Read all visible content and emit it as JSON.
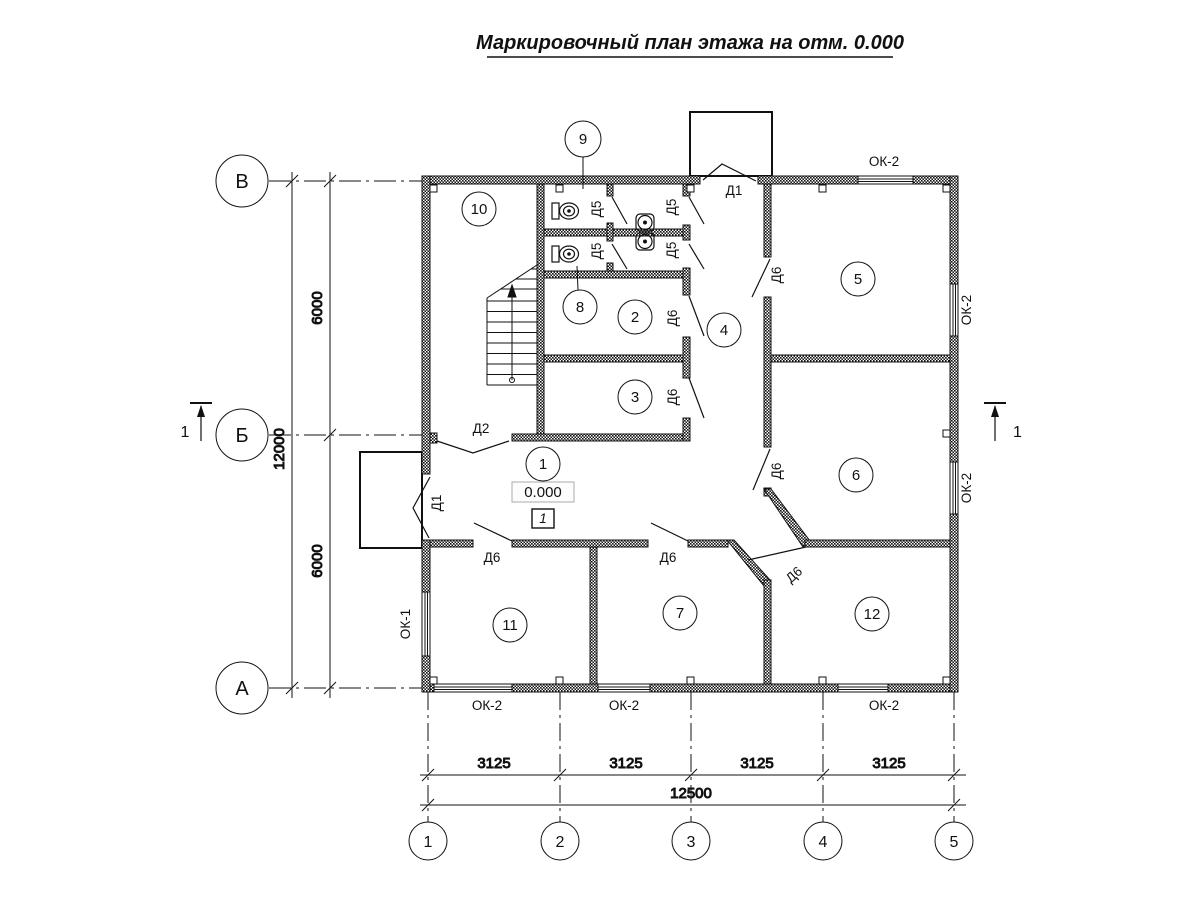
{
  "title": "Маркировочный план этажа на отм. 0.000",
  "axes": {
    "row_labels": [
      "В",
      "Б",
      "А"
    ],
    "col_labels": [
      "1",
      "2",
      "3",
      "4",
      "5"
    ]
  },
  "dimensions": {
    "left": {
      "seg1": "6000",
      "seg2": "6000",
      "total": "12000"
    },
    "bottom": {
      "seg1": "3125",
      "seg2": "3125",
      "seg3": "3125",
      "seg4": "3125",
      "total": "12500"
    }
  },
  "rooms": {
    "n1": "1",
    "n2": "2",
    "n3": "3",
    "n4": "4",
    "n5": "5",
    "n6": "6",
    "n7": "7",
    "n8": "8",
    "n9": "9",
    "n10": "10",
    "n11": "11",
    "n12": "12"
  },
  "doors": {
    "d1": "Д1",
    "d2": "Д2",
    "d5": "Д5",
    "d6": "Д6"
  },
  "windows": {
    "ok1": "ОК-1",
    "ok2": "ОК-2"
  },
  "elevation": {
    "value": "0.000",
    "zone": "1"
  },
  "section": {
    "number": "1"
  }
}
